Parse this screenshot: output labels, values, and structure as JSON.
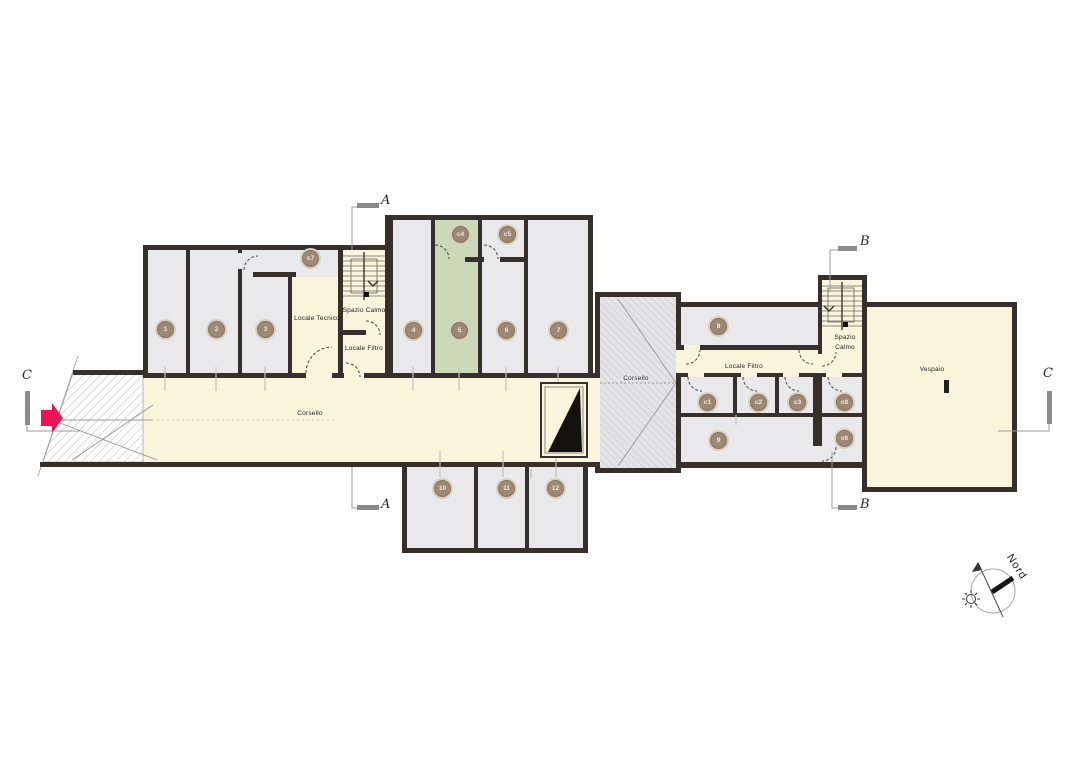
{
  "labels": {
    "corsello_main": "Corsello",
    "corsello_mid": "Corsello",
    "locale_tecnico": "Locale Tecnico",
    "spazio_calmo_left": "Spazio Calmo",
    "locale_filtro_left": "Locale Filtro",
    "locale_filtro_right": "Locale Filtro",
    "spazio_calmo_right": "Spazio Calmo",
    "vespaio": "Vespaio",
    "nord": "Nord"
  },
  "sections": {
    "a_top": "A",
    "a_bottom": "A",
    "b_top": "B",
    "b_bottom": "B",
    "c_left": "C",
    "c_right": "C"
  },
  "badges": [
    {
      "id": "room-1",
      "label": "1"
    },
    {
      "id": "room-2",
      "label": "2"
    },
    {
      "id": "room-3",
      "label": "3"
    },
    {
      "id": "room-4",
      "label": "4"
    },
    {
      "id": "room-5",
      "label": "5"
    },
    {
      "id": "room-6",
      "label": "6"
    },
    {
      "id": "room-7",
      "label": "7"
    },
    {
      "id": "room-8",
      "label": "8"
    },
    {
      "id": "room-9",
      "label": "9"
    },
    {
      "id": "room-10",
      "label": "10"
    },
    {
      "id": "room-11",
      "label": "11"
    },
    {
      "id": "room-12",
      "label": "12"
    },
    {
      "id": "room-c7",
      "label": "c7"
    },
    {
      "id": "room-c4",
      "label": "c4"
    },
    {
      "id": "room-c5",
      "label": "c5"
    },
    {
      "id": "room-c1",
      "label": "c1"
    },
    {
      "id": "room-c2",
      "label": "c2"
    },
    {
      "id": "room-c3",
      "label": "c3"
    },
    {
      "id": "room-c8",
      "label": "c8"
    },
    {
      "id": "room-c6",
      "label": "c6"
    }
  ],
  "colors": {
    "wall": "#35302b",
    "room_gray": "#e9e9eb",
    "room_green": "#ccd9b8",
    "cream": "#f9f5dd",
    "badge_fill": "#9d8875",
    "badge_ring": "#d9cfc0",
    "hatch_line": "#bdbdbd",
    "section_gray": "#8a8a8a",
    "entrance_arrow_pink": "#ec1458"
  }
}
